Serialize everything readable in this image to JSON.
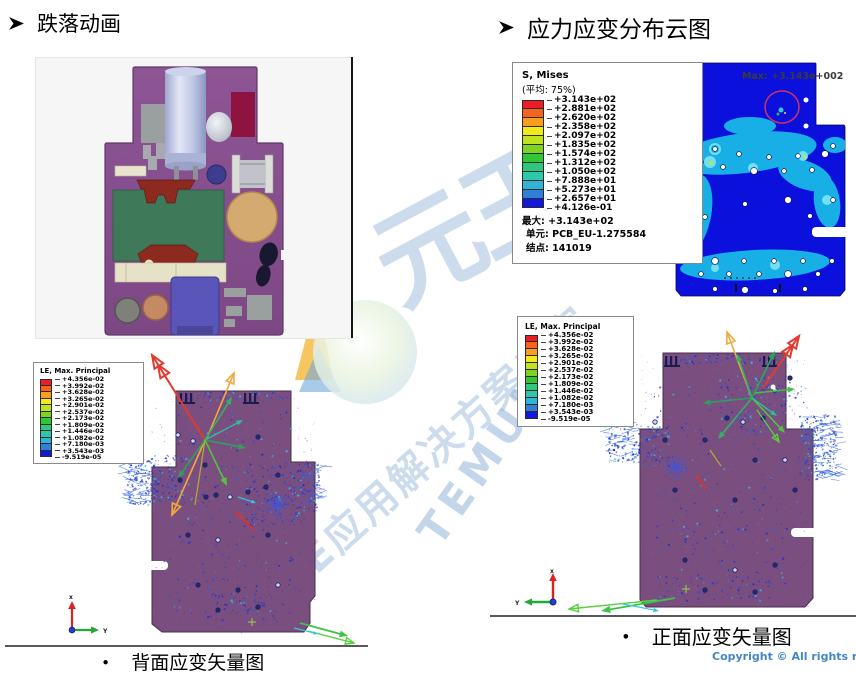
{
  "headings": {
    "left": {
      "text": "跌落动画"
    },
    "right": {
      "text": "应力应变分布云图"
    }
  },
  "icons": {
    "heading_bullet": "arrowhead-right-icon",
    "logo": "temujin-logo-icon",
    "triad": "axis-triad-icon"
  },
  "colors": {
    "spectrum": [
      "#ee1c25",
      "#f4641d",
      "#f99d1c",
      "#f2ea18",
      "#bfe31c",
      "#7ed321",
      "#2fc832",
      "#2cc87e",
      "#2bc8ab",
      "#2fb4d8",
      "#2f7fd6",
      "#1218dd"
    ],
    "watermark": "#9db9dc",
    "copyright": "#4487c9",
    "board_purple": "#7a4f80",
    "board_blue": "#0b10dc",
    "contour_cyan": "#18aee6"
  },
  "legend_mises": {
    "title": "S, Mises",
    "subtitle": "(平均: 75%)",
    "values": [
      "+3.143e+02",
      "+2.881e+02",
      "+2.620e+02",
      "+2.358e+02",
      "+2.097e+02",
      "+1.835e+02",
      "+1.574e+02",
      "+1.312e+02",
      "+1.050e+02",
      "+7.888e+01",
      "+5.273e+01",
      "+2.657e+01",
      "+4.126e-01"
    ],
    "footer": [
      "最大: +3.143e+02",
      "单元: PCB_EU-1.275584",
      "结点: 141019"
    ]
  },
  "legend_le_left": {
    "title": "LE, Max. Principal",
    "values": [
      "+4.356e-02",
      "+3.992e-02",
      "+3.628e-02",
      "+3.265e-02",
      "+2.901e-02",
      "+2.537e-02",
      "+2.173e-02",
      "+1.809e-02",
      "+1.446e-02",
      "+1.082e-02",
      "+7.180e-03",
      "+3.543e-03",
      "-9.519e-05"
    ]
  },
  "legend_le_right": {
    "title": "LE, Max. Principal",
    "values": [
      "+4.356e-02",
      "+3.992e-02",
      "+3.628e-02",
      "+3.265e-02",
      "+2.901e-02",
      "+2.537e-02",
      "+2.173e-02",
      "+1.809e-02",
      "+1.446e-02",
      "+1.082e-02",
      "+7.180e-03",
      "+3.543e-03",
      "-9.519e-05"
    ]
  },
  "annotations": {
    "max_label": "Max: +3.143e+002"
  },
  "captions": {
    "bullet": "•",
    "left": "背面应变矢量图",
    "right": "正面应变矢量图"
  },
  "watermark": {
    "brand": "元王",
    "latin": "TEMUJIN",
    "tagline": "CAE应用解决方案专家"
  },
  "footer": {
    "copyright": "Copyright © All rights reserve"
  },
  "triad": {
    "x_label": "x",
    "y_label": "Y"
  }
}
